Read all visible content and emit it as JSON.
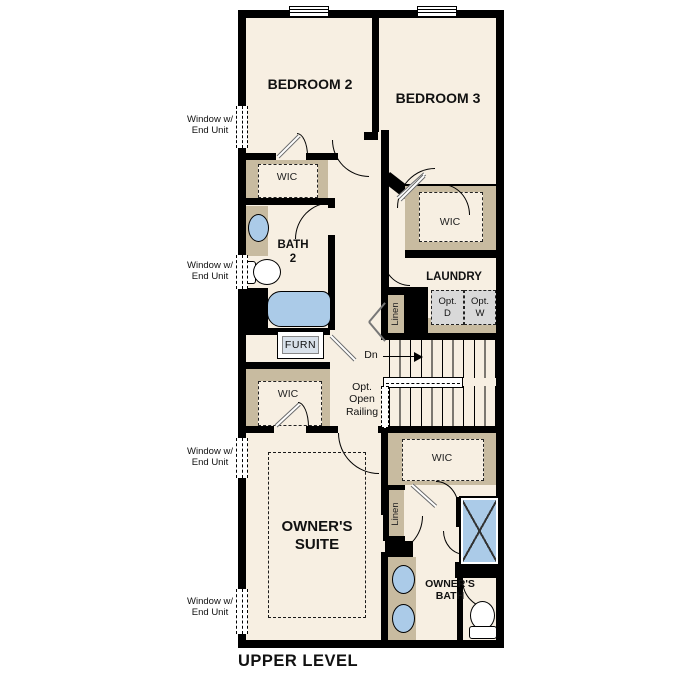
{
  "plan_title": "UPPER LEVEL",
  "rooms": {
    "bedroom2": "BEDROOM 2",
    "bedroom3": "BEDROOM 3",
    "bath2": "BATH\n2",
    "laundry": "LAUNDRY",
    "owners_suite": "OWNER'S\nSUITE",
    "owners_bath": "OWNER'S\nBATH"
  },
  "closets": {
    "wic_bedroom2": "WIC",
    "wic_bedroom3": "WIC",
    "wic_owners_front": "WIC",
    "wic_owners_rear": "WIC",
    "linen_hall": "Linen",
    "linen_owners": "Linen"
  },
  "equipment": {
    "furnace": "FURN",
    "optional_dryer": "Opt.\nD",
    "optional_washer": "Opt.\nW"
  },
  "stairs": {
    "direction": "Dn",
    "railing_note": "Opt.\nOpen\nRailing"
  },
  "notes": {
    "window_end_unit": "Window w/\nEnd Unit"
  },
  "colors": {
    "wall": "#000000",
    "floor": "#f7efe2",
    "closet": "#c8bba0",
    "fixture_blue": "#abcbe8",
    "optional_gray": "#d9d9d9",
    "background": "#ffffff"
  }
}
